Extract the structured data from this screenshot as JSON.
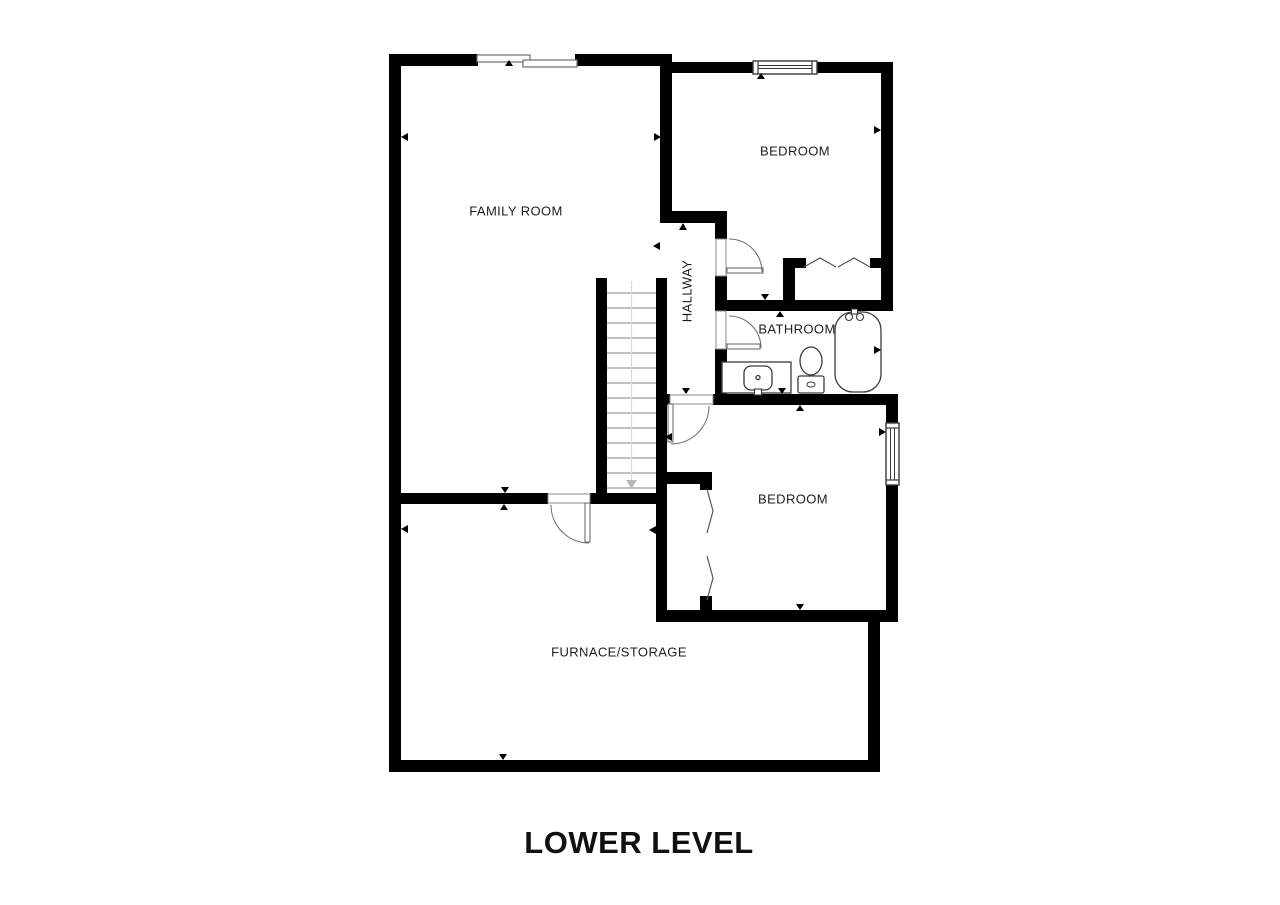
{
  "title": "LOWER LEVEL",
  "rooms": {
    "family_room": "FAMILY ROOM",
    "bedroom_upper": "BEDROOM",
    "hallway": "HALLWAY",
    "bathroom": "BATHROOM",
    "bedroom_lower": "BEDROOM",
    "furnace_storage": "FURNACE/STORAGE"
  },
  "fixtures": [
    "staircase",
    "bathtub",
    "toilet",
    "sink-vanity",
    "closet-bifold-doors"
  ],
  "features": {
    "doors": 4,
    "windows": 3,
    "closets": 2,
    "stair_treads": 14
  },
  "colors": {
    "wall": "#000000",
    "background": "#ffffff",
    "fixture_line": "#3a3a3a",
    "door_line": "#6f6f6f",
    "stair_tread": "#9a9a9a",
    "stair_arrow": "#b8b8b8",
    "label_text": "#1d1d1d"
  }
}
